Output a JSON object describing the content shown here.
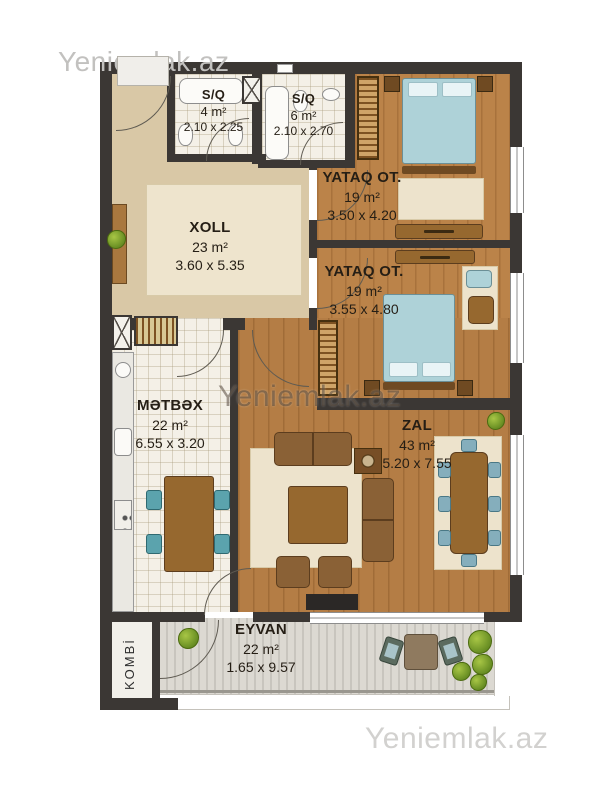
{
  "watermarks": {
    "top_left": "Yeniemlak.az",
    "center": "Yeniemlak.az",
    "bottom_right": "Yeniemlak.az"
  },
  "rooms": {
    "sq4": {
      "name": "S/Q",
      "area": "4 m²",
      "dims": "2.10 x 2.25"
    },
    "sq6": {
      "name": "S/Q",
      "area": "6 m²",
      "dims": "2.10 x 2.70"
    },
    "bedroom1": {
      "name": "YATAQ OT.",
      "area": "19 m²",
      "dims": "3.50 x 4.20"
    },
    "hall": {
      "name": "XOLL",
      "area": "23 m²",
      "dims": "3.60 x 5.35"
    },
    "bedroom2": {
      "name": "YATAQ OT.",
      "area": "19 m²",
      "dims": "3.55 x 4.80"
    },
    "kitchen": {
      "name": "MƏTBƏX",
      "area": "22 m²",
      "dims": "6.55 x 3.20"
    },
    "living": {
      "name": "ZAL",
      "area": "43 m²",
      "dims": "5.20 x 7.55"
    },
    "balcony": {
      "name": "EYVAN",
      "area": "22 m²",
      "dims": "1.65 x 9.57"
    },
    "boiler": {
      "name": "KOMBİ"
    }
  },
  "colors": {
    "wall": "#3b3734",
    "wood_floor": "#b47d45",
    "hall_floor": "#d9c8a6",
    "tile_floor": "#f4f0e7",
    "deck_floor": "#d6d3cc",
    "bed": "#aed2d8",
    "furniture_wood": "#96682f",
    "plant": "#6f9427",
    "watermark_gray": "#c2c1bf",
    "watermark_dark": "rgba(74,62,48,0.52)"
  }
}
